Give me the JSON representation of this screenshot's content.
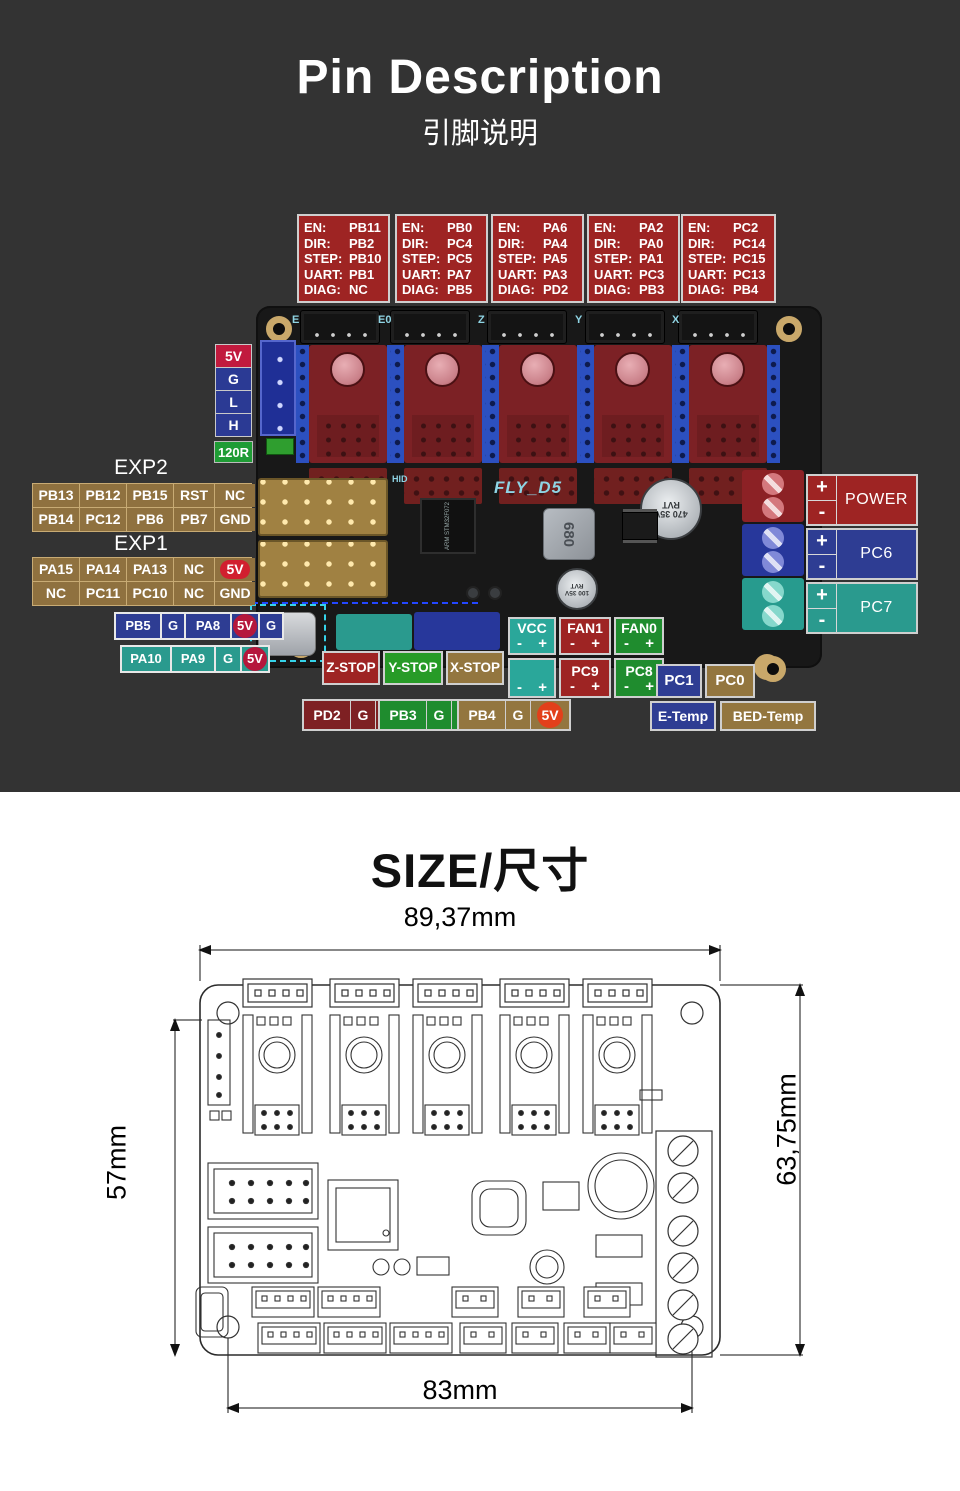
{
  "header": {
    "title": "Pin Description",
    "subtitle": "引脚说明"
  },
  "drivers": {
    "fields": [
      "EN:",
      "DIR:",
      "STEP:",
      "UART:",
      "DIAG:"
    ],
    "boxes": [
      {
        "en": "PB11",
        "dir": "PB2",
        "step": "PB10",
        "uart": "PB1",
        "diag": "NC"
      },
      {
        "en": "PB0",
        "dir": "PC4",
        "step": "PC5",
        "uart": "PA7",
        "diag": "PB5"
      },
      {
        "en": "PA6",
        "dir": "PA4",
        "step": "PA5",
        "uart": "PA3",
        "diag": "PD2"
      },
      {
        "en": "PA2",
        "dir": "PA0",
        "step": "PA1",
        "uart": "PC3",
        "diag": "PB3"
      },
      {
        "en": "PC2",
        "dir": "PC14",
        "step": "PC15",
        "uart": "PC13",
        "diag": "PB4"
      }
    ]
  },
  "board": {
    "name": "FLY_D5",
    "hid": "HID",
    "motor_ports": [
      "E",
      "E0",
      "Z",
      "Y",
      "X"
    ],
    "components": {
      "mcu": "ARM STM32F072",
      "inductor": "680",
      "cap_large": "470 35V RVT",
      "cap_small": "100 35V RVT",
      "driver_cap": "100 35V RVT"
    }
  },
  "left_panel": {
    "bus_pins": [
      "5V",
      "G",
      "L",
      "H"
    ],
    "resistor": "120R",
    "exp2": {
      "title": "EXP2",
      "rows": [
        [
          "PB13",
          "PB12",
          "PB15",
          "RST",
          "NC"
        ],
        [
          "PB14",
          "PC12",
          "PB6",
          "PB7",
          "GND"
        ]
      ]
    },
    "exp1": {
      "title": "EXP1",
      "rows": [
        [
          "PA15",
          "PA14",
          "PA13",
          "NC",
          "5V"
        ],
        [
          "NC",
          "PC11",
          "PC10",
          "NC",
          "GND"
        ]
      ]
    },
    "usb_row1": [
      "PB5",
      "G",
      "PA8",
      "5V",
      "G"
    ],
    "usb_row2": [
      "PA10",
      "PA9",
      "G",
      "5V"
    ]
  },
  "bottom_panel": {
    "endstops": [
      "Z-STOP",
      "Y-STOP",
      "X-STOP"
    ],
    "vcc": {
      "label": "VCC",
      "polarity": "- +"
    },
    "fan1": {
      "label": "FAN1",
      "polarity": "- +"
    },
    "fan0": {
      "label": "FAN0",
      "polarity": "- +"
    },
    "aux_polarity": "- +",
    "pc9": {
      "label": "PC9",
      "polarity": "- +"
    },
    "pc8": {
      "label": "PC8",
      "polarity": "- +"
    },
    "pc1": "PC1",
    "pc0": "PC0",
    "heaters": [
      [
        "PD2",
        "G",
        "5V"
      ],
      [
        "PB3",
        "G",
        "5V"
      ],
      [
        "PB4",
        "G",
        "5V"
      ]
    ],
    "e_temp": "E-Temp",
    "bed_temp": "BED-Temp"
  },
  "right_panel": {
    "terminals": [
      {
        "label": "POWER",
        "plus": "+",
        "minus": "-"
      },
      {
        "label": "PC6",
        "plus": "+",
        "minus": "-"
      },
      {
        "label": "PC7",
        "plus": "+",
        "minus": "-"
      }
    ]
  },
  "size_section": {
    "title": "SIZE/尺寸",
    "width_top": "89,37mm",
    "height_left": "57mm",
    "height_right": "63,75mm",
    "width_bottom": "83mm"
  },
  "colors": {
    "page_dark_bg": "#333333",
    "annotation_red": "#9e2423",
    "annotation_blue": "#2e3d93",
    "annotation_teal": "#2a9a8e",
    "annotation_green": "#1f8c2e",
    "annotation_tan": "#8f713f",
    "crimson_5v": "#c11a3e",
    "resistor_green": "#1f9c35",
    "silkscreen_cyan": "#8fd4e4"
  }
}
